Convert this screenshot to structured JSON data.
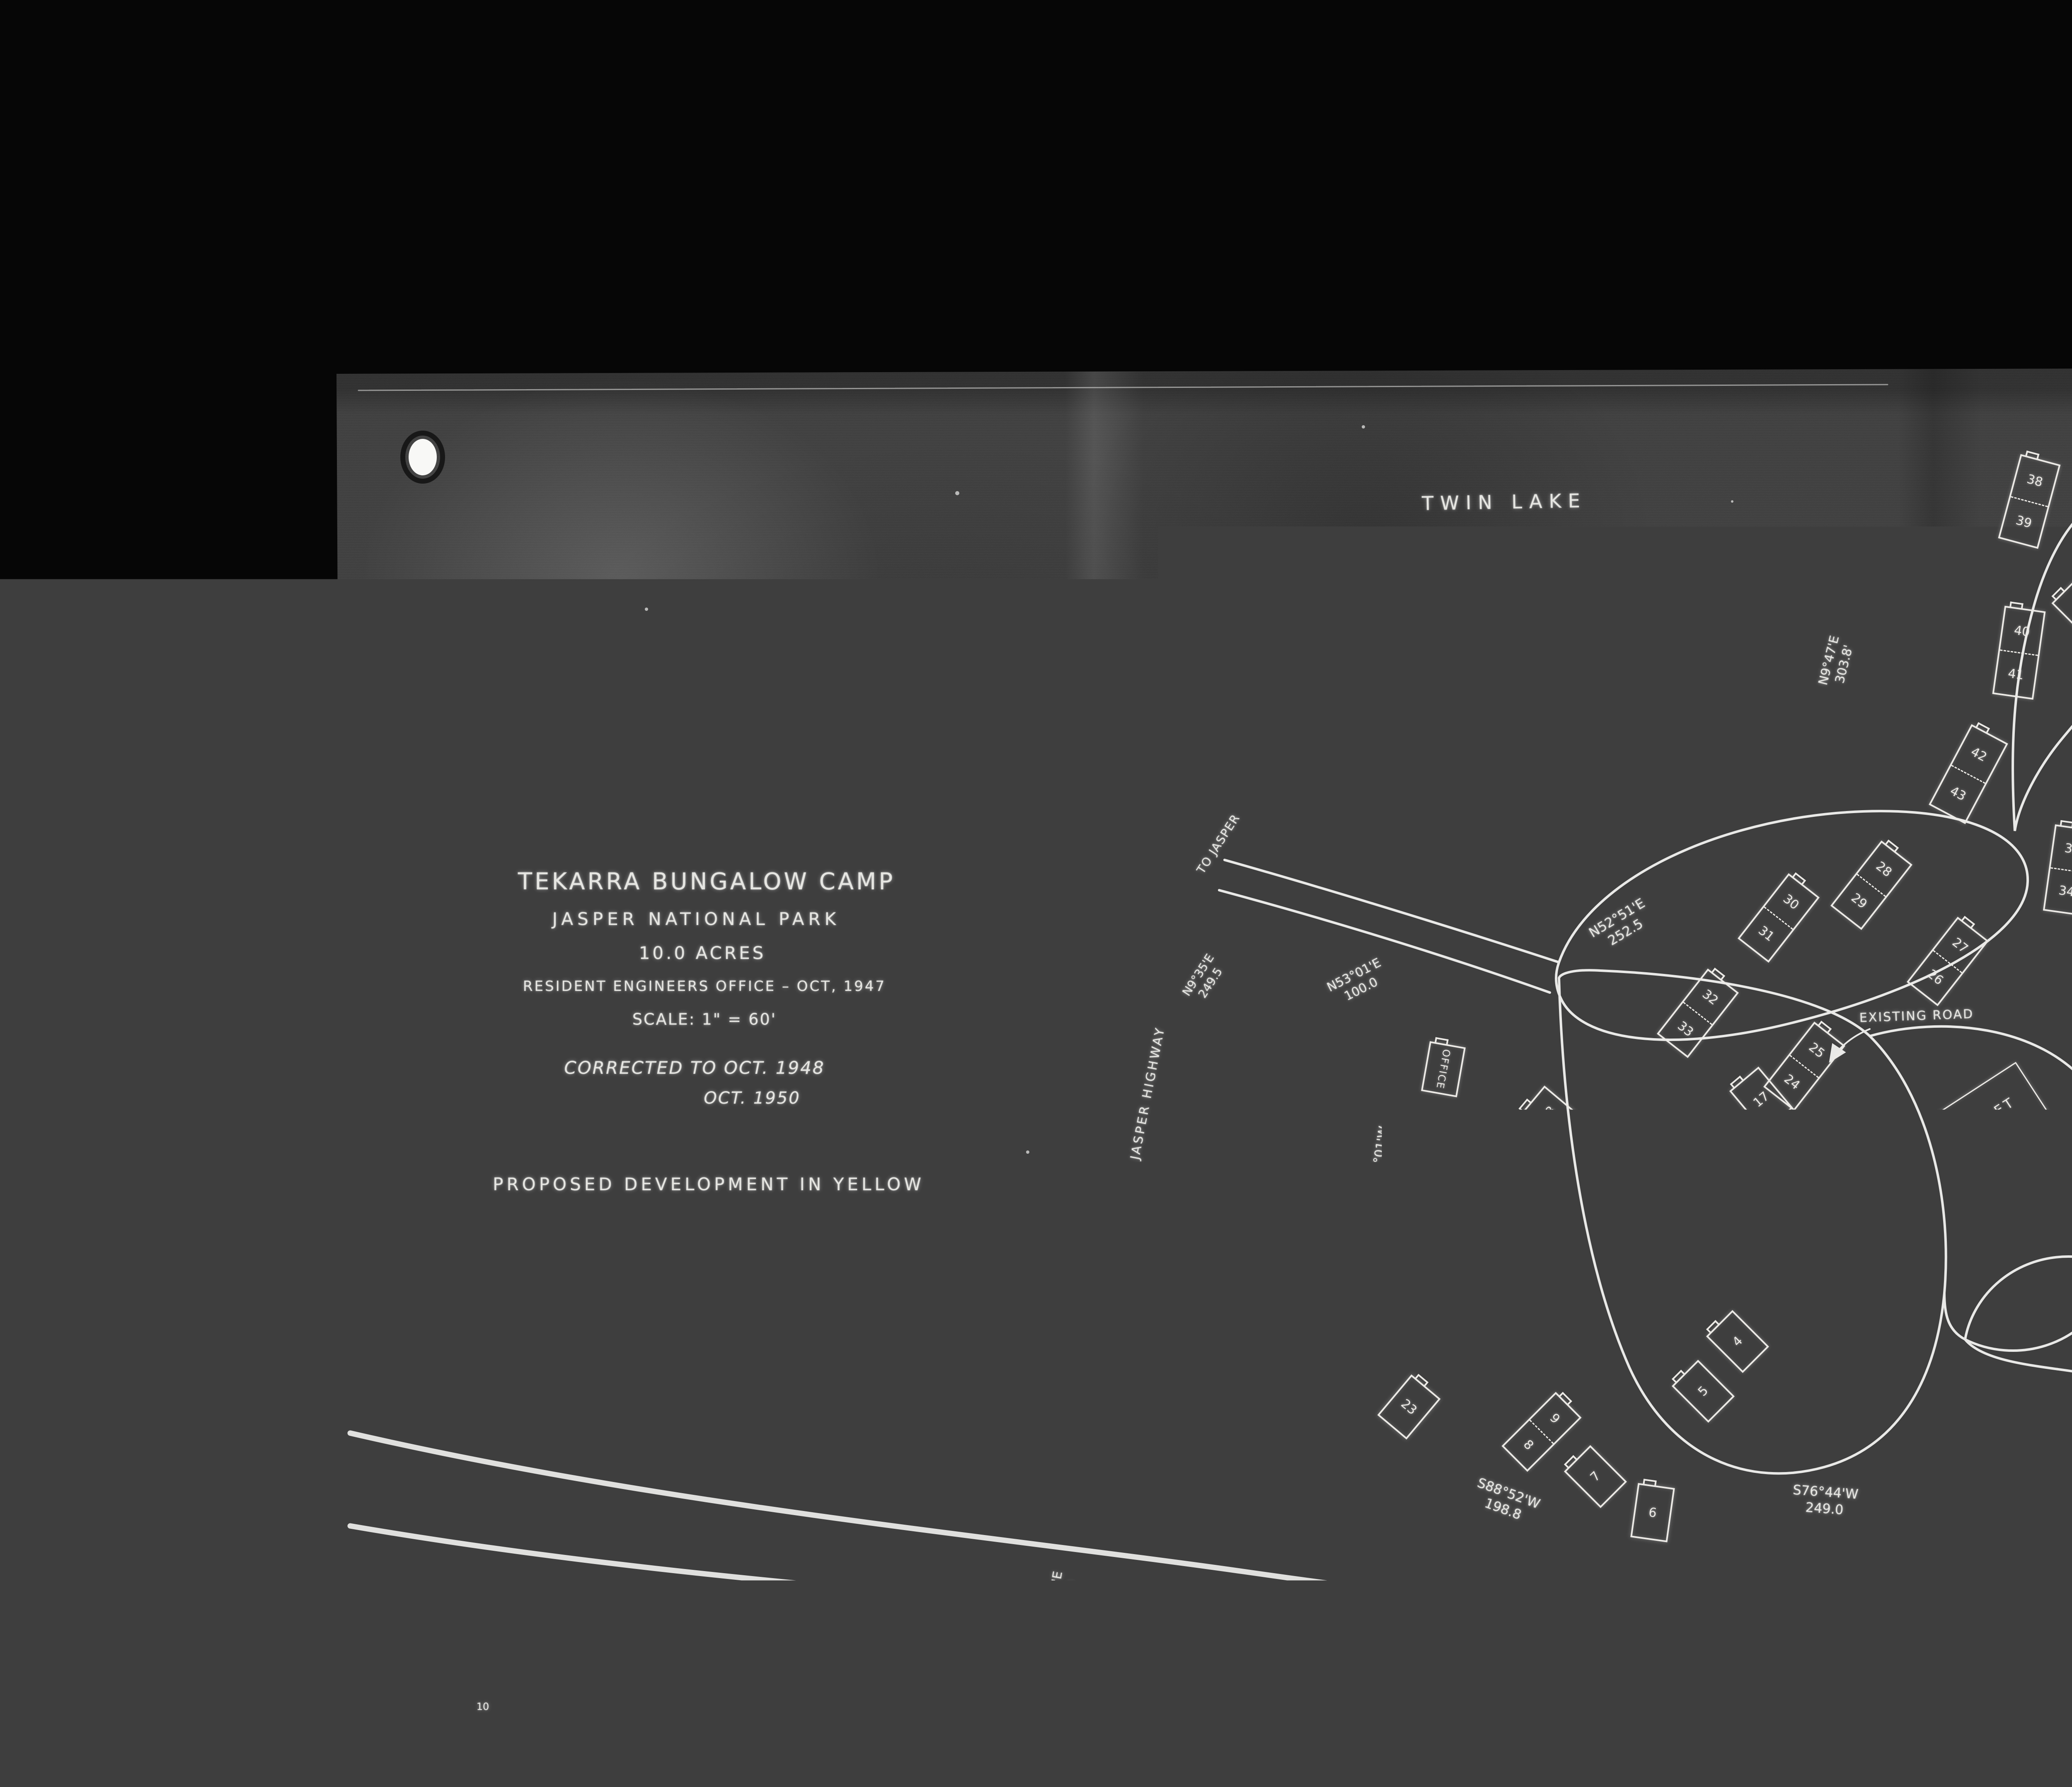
{
  "title_block": {
    "line1": "TEKARRA BUNGALOW CAMP",
    "line2": "JASPER NATIONAL PARK",
    "line3": "10.0 ACRES",
    "line4": "RESIDENT ENGINEERS OFFICE  –  OCT, 1947",
    "line5": "SCALE: 1\" = 60'",
    "line6": "CORRECTED TO OCT. 1948",
    "line7": "OCT. 1950",
    "line8": "PROPOSED DEVELOPMENT IN YELLOW"
  },
  "places": {
    "twin_lake": "TWIN LAKE",
    "wood_shed": "WOOD SHED",
    "proposed_road": "PROPOSED ROAD",
    "existing_road": "EXISTING ROAD",
    "chalet": "CHALET",
    "office": "OFFICE",
    "staff": "Staff",
    "tennis_courts": "TENNIS COURTS",
    "bowling": "BOWLING",
    "recreation": "RECREATION",
    "area": "AREA",
    "parking": "PARKING",
    "main_building": "MAIN BUILDING 65'x120'",
    "miette_river": "MIETTE RIVER",
    "river": "RIVER",
    "to_jasper": "TO JASPER",
    "banff_jasper_highway": "BANFF JASPER HIGHWAY"
  },
  "bearings": [
    {
      "text": "N9°47'E",
      "dist": "303.8'"
    },
    {
      "text": "S89°46'E",
      "dist": "581.4'"
    },
    {
      "text": "N52°51'E",
      "dist": "252.5"
    },
    {
      "text": "N53°01'E",
      "dist": "100.0"
    },
    {
      "text": "N9°35'E",
      "dist": "249.5"
    },
    {
      "text": "N7°01'W",
      "dist": "295.0'"
    },
    {
      "text": "S88°52'W",
      "dist": "198.8"
    },
    {
      "text": "S76°44'W",
      "dist": "249.0"
    },
    {
      "text": "S80°56'W",
      "dist": "398.8'"
    },
    {
      "text": "N2°27'E",
      "dist": "379.9"
    },
    {
      "text": "N58°05'E",
      "dist": "219.3"
    }
  ],
  "survey": {
    "ipn": "I.P.N. M.",
    "pt9": "9",
    "pt10": "10"
  },
  "cabins": [
    {
      "a": "38",
      "b": "39"
    },
    {
      "label": "37"
    },
    {
      "label": "36"
    },
    {
      "a": "40",
      "b": "41"
    },
    {
      "a": "42",
      "b": "43"
    },
    {
      "a": "35",
      "b": "34"
    },
    {
      "a": "30",
      "b": "31"
    },
    {
      "a": "28",
      "b": "29"
    },
    {
      "a": "27",
      "b": "26"
    },
    {
      "a": "32",
      "b": "33"
    },
    {
      "a": "25",
      "b": "24"
    },
    {
      "a": "18",
      "b": "19"
    },
    {
      "label": "20"
    },
    {
      "label": "21"
    },
    {
      "label": "22"
    },
    {
      "label": "23"
    },
    {
      "label": "17"
    },
    {
      "a": "16",
      "b": "15"
    },
    {
      "label": "14"
    },
    {
      "a": "12",
      "b": "11"
    },
    {
      "label": "10"
    },
    {
      "a": "9",
      "b": "8"
    },
    {
      "label": "7"
    },
    {
      "label": "6"
    },
    {
      "label": "5"
    },
    {
      "label": "1"
    },
    {
      "a": "2",
      "b": "3"
    },
    {
      "label": "4"
    }
  ],
  "stamps": {
    "stamp1": "1 of dc",
    "stamp2_line1": "REPEAT",
    "stamp2_line2": "REPETITION"
  },
  "colors": {
    "background": "#060606",
    "paper": "#3e3e3e",
    "ink": "#e9e9e7"
  }
}
